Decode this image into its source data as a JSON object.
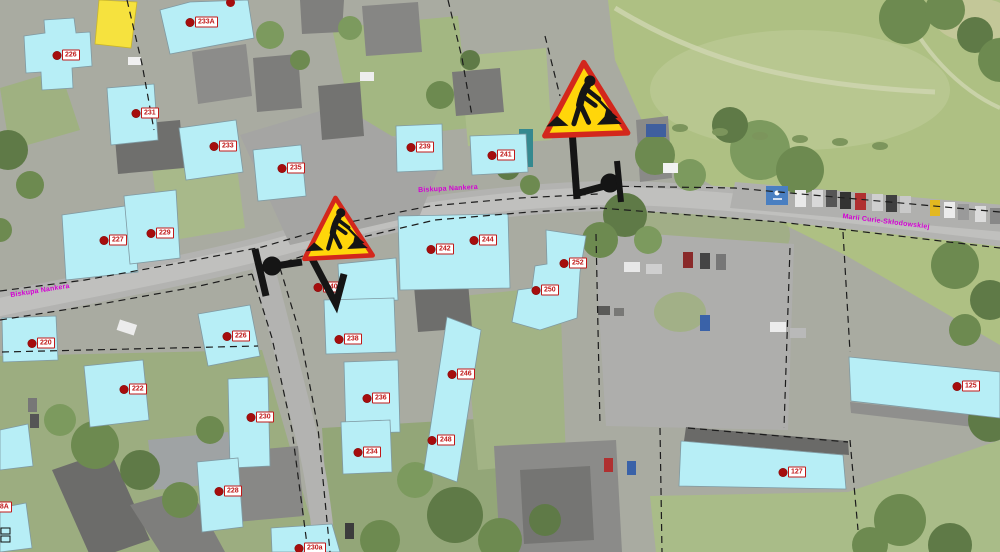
{
  "map": {
    "streets": [
      {
        "name": "Biskupa Nankera",
        "x": 40,
        "y": 291,
        "rot": -9
      },
      {
        "name": "Biskupa Nankera",
        "x": 448,
        "y": 189,
        "rot": -3
      },
      {
        "name": "Marii Curie-Skłodowskiej",
        "x": 886,
        "y": 222,
        "rot": 7
      }
    ],
    "buildings": [
      {
        "number": "226",
        "x": 57,
        "y": 55
      },
      {
        "number": "233A",
        "x": 190,
        "y": 22
      },
      {
        "number": "231",
        "x": 136,
        "y": 113
      },
      {
        "number": "233",
        "x": 214,
        "y": 146
      },
      {
        "number": "235",
        "x": 282,
        "y": 168
      },
      {
        "number": "239",
        "x": 411,
        "y": 147
      },
      {
        "number": "241",
        "x": 492,
        "y": 155
      },
      {
        "number": "227",
        "x": 104,
        "y": 240
      },
      {
        "number": "229",
        "x": 151,
        "y": 233
      },
      {
        "number": "220",
        "x": 32,
        "y": 343
      },
      {
        "number": "222",
        "x": 124,
        "y": 389
      },
      {
        "number": "226",
        "x": 227,
        "y": 336
      },
      {
        "number": "228",
        "x": 219,
        "y": 491
      },
      {
        "number": "230",
        "x": 251,
        "y": 417
      },
      {
        "number": "230a",
        "x": 299,
        "y": 548
      },
      {
        "number": "18A",
        "x": -12,
        "y": 507
      },
      {
        "number": "234",
        "x": 358,
        "y": 452
      },
      {
        "number": "236",
        "x": 367,
        "y": 398
      },
      {
        "number": "238",
        "x": 339,
        "y": 339
      },
      {
        "number": "240",
        "x": 318,
        "y": 287
      },
      {
        "number": "242",
        "x": 431,
        "y": 249
      },
      {
        "number": "244",
        "x": 474,
        "y": 240
      },
      {
        "number": "246",
        "x": 452,
        "y": 374
      },
      {
        "number": "248",
        "x": 432,
        "y": 440
      },
      {
        "number": "250",
        "x": 536,
        "y": 290
      },
      {
        "number": "252",
        "x": 564,
        "y": 263
      },
      {
        "number": "125",
        "x": 957,
        "y": 386
      },
      {
        "number": "127",
        "x": 783,
        "y": 472
      }
    ],
    "extra_dots": [
      {
        "x": 230,
        "y": 2
      }
    ],
    "signs": [
      {
        "type": "roadworks",
        "x": 539,
        "y": 58,
        "size": 92,
        "rot": -2
      },
      {
        "type": "roadworks",
        "x": 299,
        "y": 194,
        "size": 76,
        "rot": -3
      }
    ],
    "colors": {
      "building_overlay": "#b7eef6",
      "label_red": "#c01818",
      "street_magenta": "#d400d4",
      "sign_yellow": "#ffd60a",
      "sign_border_red": "#d3271c"
    }
  }
}
